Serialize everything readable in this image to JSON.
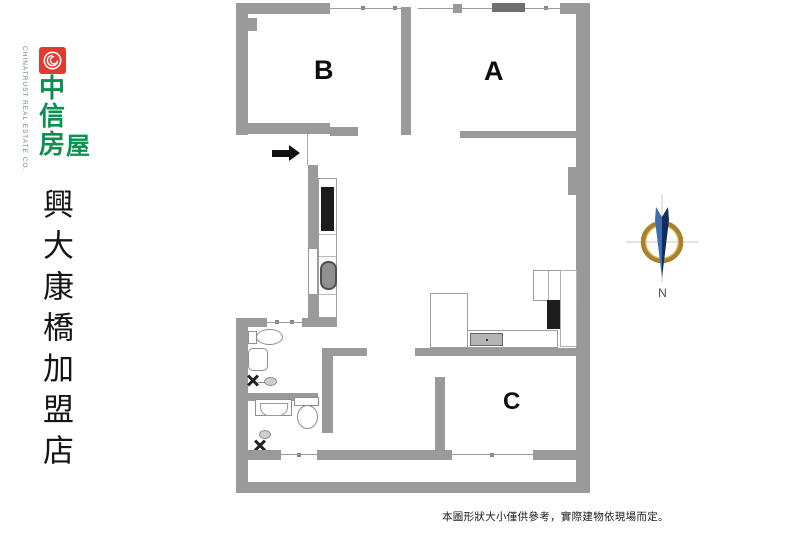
{
  "branding": {
    "company_chars": [
      "中",
      "信",
      "房",
      "屋"
    ],
    "company_subtitle": "CHINATRUST REAL ESTATE CO.",
    "branch_name": "興大康橋加盟店"
  },
  "floor_plan": {
    "rooms": [
      {
        "label": "B"
      },
      {
        "label": "A"
      },
      {
        "label": "C"
      }
    ],
    "symbols": [
      "entry-arrow",
      "toilet",
      "bathtub",
      "washbasin",
      "exhaust-fan",
      "kitchen-sink",
      "stove",
      "refrigerator",
      "cabinet"
    ]
  },
  "compass": {
    "north_label": "N"
  },
  "disclaimer": "本圖形狀大小僅供參考，實際建物依現場而定。",
  "colors": {
    "wall": "#9A9A9A",
    "logo_red": "#E23A2E",
    "brand_green": "#0A9150",
    "compass_ring": "#A8832B",
    "compass_needle_dark": "#142C57",
    "compass_needle_light": "#3D6CB0",
    "arrow_black": "#111111"
  }
}
